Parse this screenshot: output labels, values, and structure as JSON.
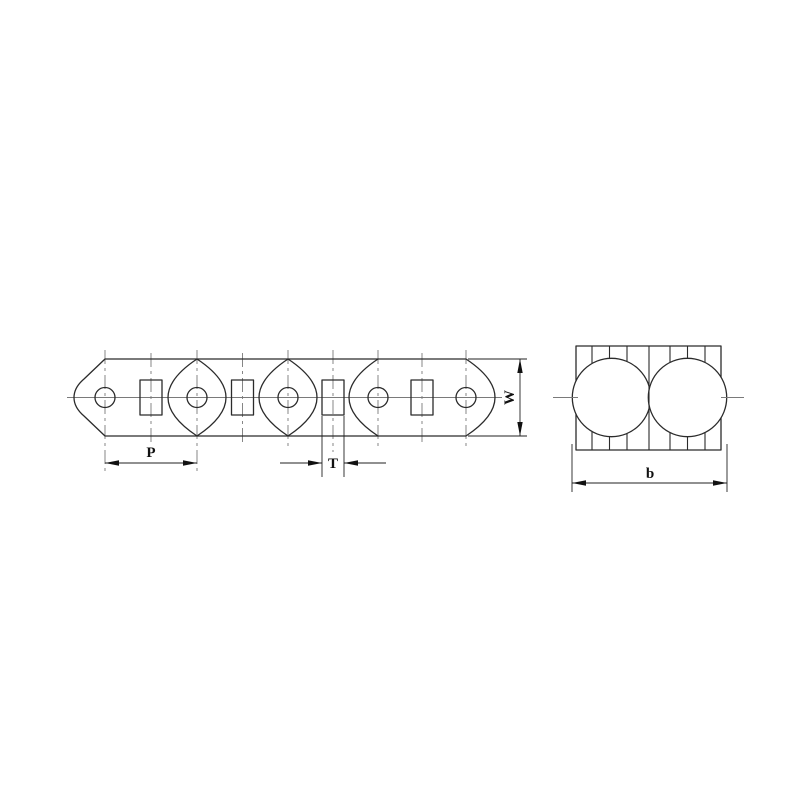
{
  "drawing": {
    "type": "engineering-two-view-chain-drawing",
    "colors": {
      "background": "#ffffff",
      "outline": "#2b2b2b",
      "centerline": "#7a7a7a",
      "dimension": "#111111"
    },
    "side_view": {
      "hole_count": 5,
      "bushing_count": 4,
      "dimensions": {
        "pitch_label": "P",
        "thickness_label": "T",
        "width_label": "W"
      }
    },
    "end_view": {
      "roller_count": 2,
      "dimensions": {
        "overall_width_label": "b"
      }
    }
  }
}
